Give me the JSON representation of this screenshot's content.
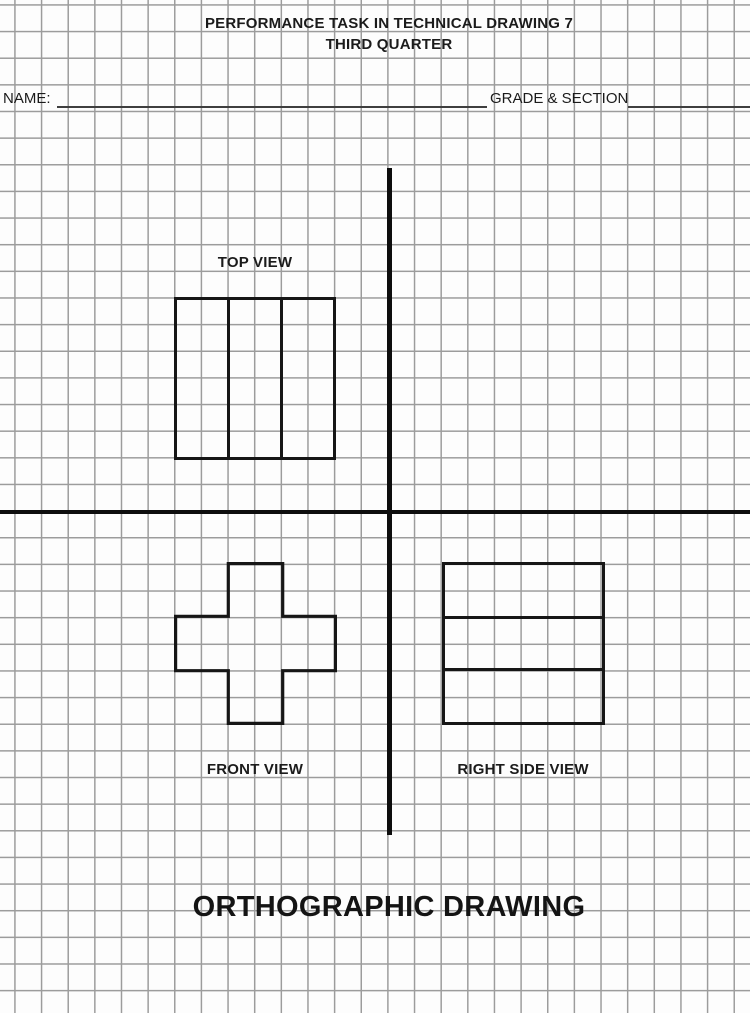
{
  "document": {
    "title_line1": "PERFORMANCE TASK IN TECHNICAL DRAWING 7",
    "title_line2": "THIRD QUARTER",
    "footer_title": "ORTHOGRAPHIC DRAWING"
  },
  "form": {
    "name_label": "NAME:",
    "name_value": "",
    "grade_section_label": "GRADE & SECTION",
    "grade_section_value": ""
  },
  "views": {
    "top": {
      "label": "TOP VIEW",
      "shape": "square outline divided into 3 equal vertical columns"
    },
    "front": {
      "label": "FRONT VIEW",
      "shape": "symmetric plus (cross) outline"
    },
    "right_side": {
      "label": "RIGHT SIDE VIEW",
      "shape": "square outline divided into 3 equal horizontal rows"
    }
  },
  "colors": {
    "paper": "#fdfdfd",
    "grid_line": "#9c9c9c",
    "ink": "#161616",
    "axis": "#0d0d0d"
  }
}
